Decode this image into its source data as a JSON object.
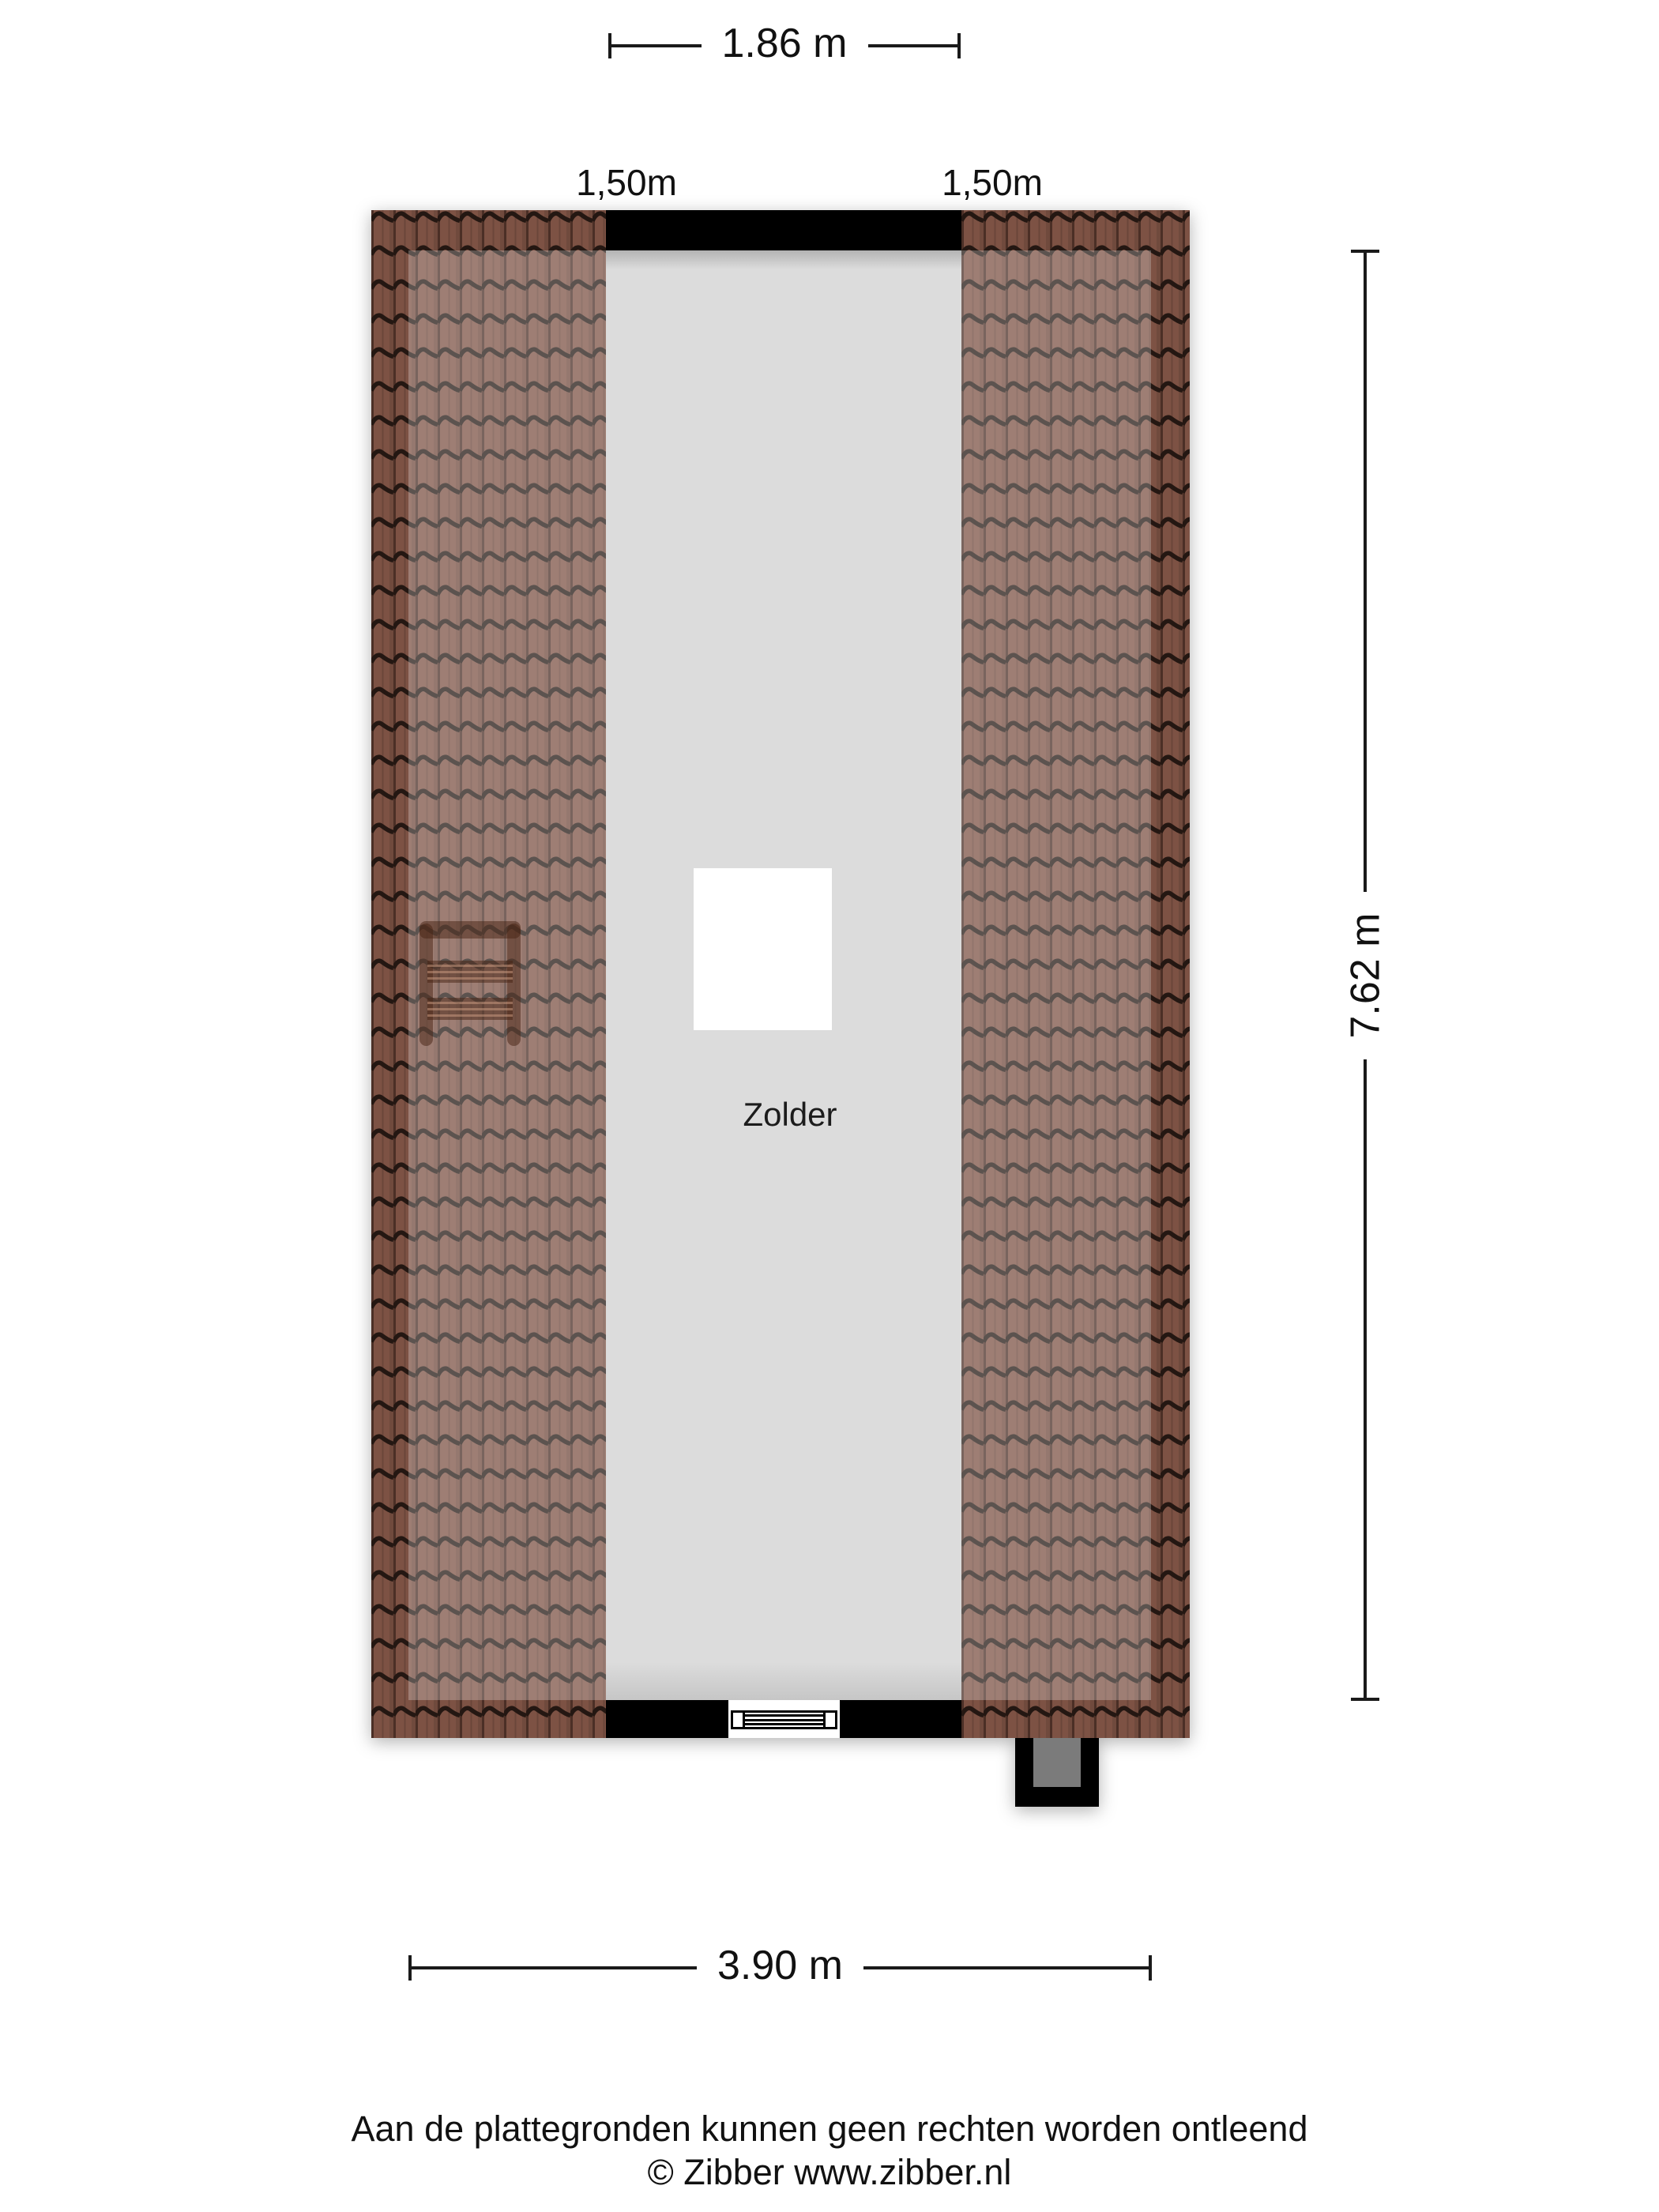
{
  "dimensions": {
    "top": "1.86 m",
    "right": "7.62 m",
    "bottom": "3.90 m",
    "knee_left": "1,50m",
    "knee_right": "1,50m"
  },
  "room": {
    "label": "Zolder"
  },
  "footer": {
    "disclaimer": "Aan de plattegronden kunnen geen rechten worden ontleend",
    "copyright": "© Zibber www.zibber.nl"
  },
  "colors": {
    "page": "#ffffff",
    "wall": "#000000",
    "room": "#dcdcdc",
    "dim": "#1a1a1a",
    "text": "#111111",
    "tile_base": "#7d5244",
    "tile_line": "#241712",
    "tile_inner_overlay": "rgba(255,255,255,0.26)",
    "chimney_flue": "#7b7b7b",
    "object": "rgba(70,33,18,0.5)"
  }
}
